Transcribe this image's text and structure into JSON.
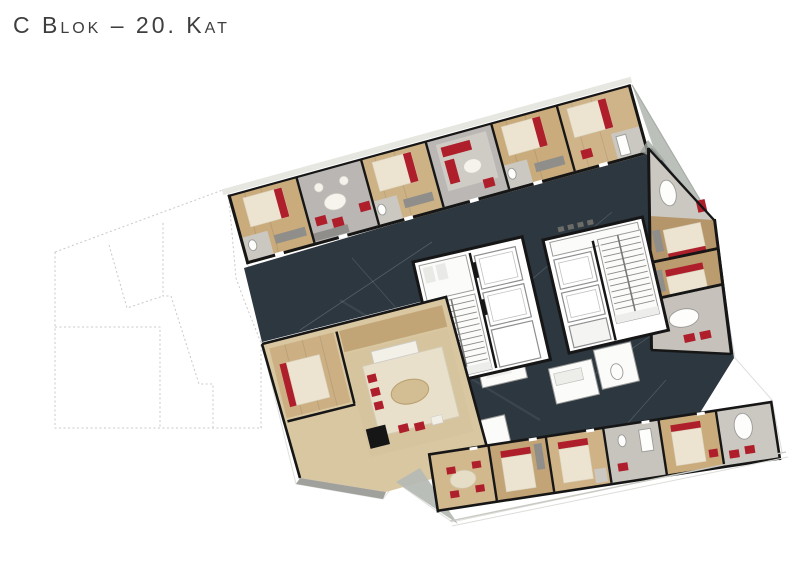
{
  "page": {
    "title": "C Blok – 20. Kat",
    "background": "#ffffff"
  },
  "plan": {
    "description": "rendered-architectural-floor-plan",
    "parts": [
      "adjacent-block-outline",
      "building-silhouette",
      "corridor-floor",
      "top-wing",
      "terrace-top",
      "right-wing",
      "core-1",
      "core-2",
      "service-rooms",
      "lower-left-apartment",
      "bottom-wing",
      "terrace-bottom",
      "balcony-edge"
    ]
  },
  "colors": {
    "page_bg": "#ffffff",
    "title_text": "#3e3e3e",
    "wall": "#161616",
    "corridor": "#2d3740",
    "wood_light": "#d9c7a1",
    "wood_mid": "#c9ab7c",
    "wood_dark": "#b5966a",
    "floor_gray": "#b9b6b4",
    "bath_tile": "#cbc8c1",
    "bed_cream": "#ece4d0",
    "accent_red": "#ae1f2b",
    "terrace_gray": "#b6bbb4",
    "outline_dash": "#c8c8c8",
    "balcony_line": "#c9c9c4",
    "closet_gray": "#8f8e8a",
    "elevator_outline": "#8e8e8e"
  }
}
